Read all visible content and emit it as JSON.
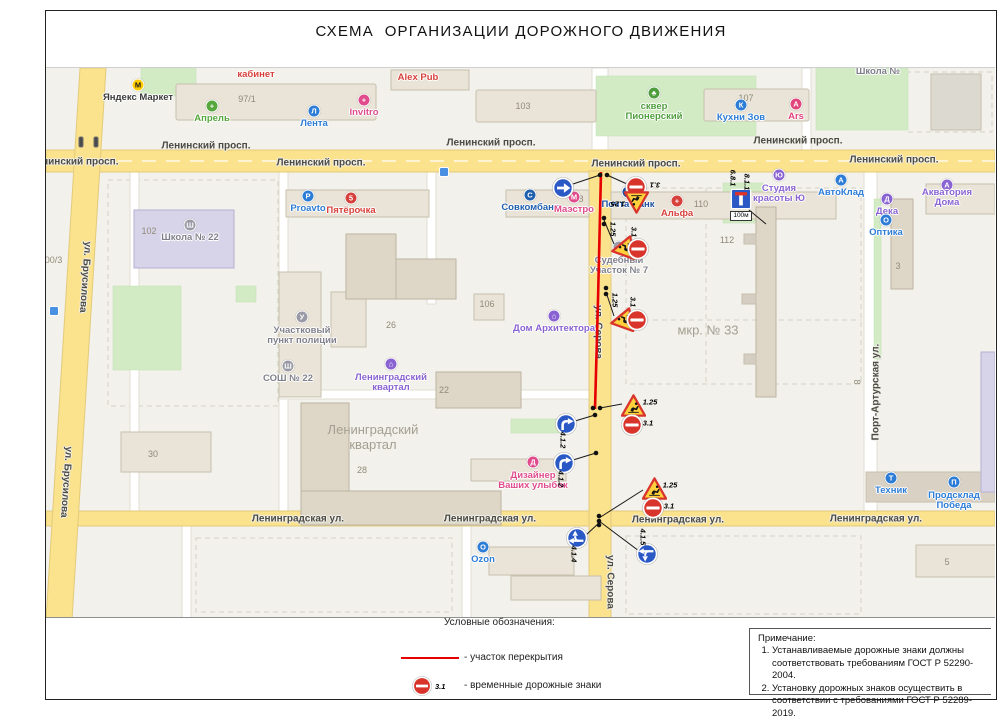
{
  "title": "СХЕМА  ОРГАНИЗАЦИИ ДОРОЖНОГО ДВИЖЕНИЯ",
  "legend": {
    "heading": "Условные обозначения:",
    "closure_label": "-  участок перекрытия",
    "signs_label": "- временные дорожные знаки",
    "sign_code": "3.1"
  },
  "notes": {
    "heading": "Примечание:",
    "items": [
      "Устанавливаемые дорожные знаки должны соответствовать требованиям ГОСТ Р 52290-2004.",
      "Установку дорожных знаков осуществить в соответствии с требованиями ГОСТ Р 52289-2019."
    ]
  },
  "colors": {
    "closure": "#e60000",
    "leader": "#1a1a1a",
    "sign_red": "#d8342c",
    "sign_blue": "#2a59c6",
    "temp_yellow": "#ffd03b",
    "road_yellow": "#fbe28c",
    "map_bg": "#f2f1eb"
  },
  "map": {
    "street_labels": [
      {
        "t": "Ленинский просп.",
        "x": 28,
        "y": 94
      },
      {
        "t": "Ленинский просп.",
        "x": 160,
        "y": 78
      },
      {
        "t": "Ленинский просп.",
        "x": 275,
        "y": 95
      },
      {
        "t": "Ленинский просп.",
        "x": 445,
        "y": 75
      },
      {
        "t": "Ленинский просп.",
        "x": 590,
        "y": 96
      },
      {
        "t": "Ленинский просп.",
        "x": 752,
        "y": 73
      },
      {
        "t": "Ленинский просп.",
        "x": 848,
        "y": 92
      },
      {
        "t": "Ленинградская ул.",
        "x": 252,
        "y": 451
      },
      {
        "t": "Ленинградская ул.",
        "x": 444,
        "y": 451
      },
      {
        "t": "Ленинградская ул.",
        "x": 632,
        "y": 452
      },
      {
        "t": "Ленинградская ул.",
        "x": 830,
        "y": 451
      },
      {
        "t": "ул. Брусилова",
        "x": 39,
        "y": 209,
        "rot": 94
      },
      {
        "t": "ул. Брусилова",
        "x": 20,
        "y": 414,
        "rot": 94
      },
      {
        "t": "ул. Серова",
        "x": 552,
        "y": 264,
        "rot": 90
      },
      {
        "t": "ул. Серова",
        "x": 564,
        "y": 514,
        "rot": 90
      },
      {
        "t": "Порт-Артурская ул.",
        "x": 830,
        "y": 324,
        "rot": -90
      }
    ],
    "area_labels": [
      {
        "t": "Ленинградский\nквартал",
        "x": 327,
        "y": 369
      },
      {
        "t": "мкр. № 33",
        "x": 662,
        "y": 262
      }
    ],
    "house_numbers": [
      {
        "t": "97/1",
        "x": 201,
        "y": 31
      },
      {
        "t": "102",
        "x": 103,
        "y": 163
      },
      {
        "t": "103",
        "x": 477,
        "y": 38
      },
      {
        "t": "106",
        "x": 441,
        "y": 236
      },
      {
        "t": "107",
        "x": 700,
        "y": 30
      },
      {
        "t": "110",
        "x": 655,
        "y": 136
      },
      {
        "t": "112",
        "x": 681,
        "y": 172
      },
      {
        "t": "128",
        "x": 530,
        "y": 131
      },
      {
        "t": "22",
        "x": 398,
        "y": 322
      },
      {
        "t": "26",
        "x": 345,
        "y": 257
      },
      {
        "t": "28",
        "x": 316,
        "y": 402
      },
      {
        "t": "30",
        "x": 107,
        "y": 386
      },
      {
        "t": "3",
        "x": 852,
        "y": 198
      },
      {
        "t": "5",
        "x": 901,
        "y": 494
      },
      {
        "t": "8",
        "x": 811,
        "y": 314,
        "rot": 90
      },
      {
        "t": "100/3",
        "x": 5,
        "y": 192
      }
    ],
    "pois": [
      {
        "id": "yandex-market",
        "t": "Яндекс Маркет",
        "x": 92,
        "y": 30,
        "c": "#3b3b3b",
        "g": "М",
        "bg": "#ffcc00",
        "gc": "#1a1a1a"
      },
      {
        "id": "aprel",
        "t": "Апрель",
        "x": 166,
        "y": 51,
        "c": "#56a73c",
        "g": "+",
        "bg": "#56a73c"
      },
      {
        "id": "lenta",
        "t": "Лента",
        "x": 268,
        "y": 56,
        "c": "#2d7cd6",
        "g": "Л",
        "bg": "#2d7cd6"
      },
      {
        "id": "invitro",
        "t": "Invitro",
        "x": 318,
        "y": 45,
        "c": "#df4b8b",
        "g": "+",
        "bg": "#df4b8b"
      },
      {
        "id": "alex-pub",
        "t": "Alex Pub",
        "x": 372,
        "y": 10,
        "c": "#d6413c"
      },
      {
        "id": "kabinet",
        "t": "кабинет",
        "x": 210,
        "y": 7,
        "c": "#d6413c"
      },
      {
        "id": "skver-pionersky",
        "t": "сквер\nПионерский",
        "x": 608,
        "y": 44,
        "c": "#4f9e3e",
        "g": "♣",
        "bg": "#4f9e3e"
      },
      {
        "id": "kuhni-zov",
        "t": "Кухни Зов",
        "x": 695,
        "y": 50,
        "c": "#2d7cd6",
        "g": "К",
        "bg": "#2d7cd6"
      },
      {
        "id": "ars",
        "t": "Ars",
        "x": 750,
        "y": 49,
        "c": "#e0457b",
        "g": "A",
        "bg": "#e0457b"
      },
      {
        "id": "shkola-n",
        "t": "Школа №",
        "x": 832,
        "y": 4,
        "c": "#80808c"
      },
      {
        "id": "proavto",
        "t": "Proavto",
        "x": 262,
        "y": 141,
        "c": "#2d7cd6",
        "g": "P",
        "bg": "#2d7cd6"
      },
      {
        "id": "pyaterochka",
        "t": "Пятёрочка",
        "x": 305,
        "y": 143,
        "c": "#d6413c",
        "g": "5",
        "bg": "#d6413c"
      },
      {
        "id": "sovcombank",
        "t": "Совкомбанк",
        "x": 484,
        "y": 140,
        "c": "#1f5fae",
        "g": "С",
        "bg": "#1f5fae"
      },
      {
        "id": "maestro",
        "t": "Маэстро",
        "x": 528,
        "y": 142,
        "c": "#df4b8b",
        "g": "М",
        "bg": "#df4b8b"
      },
      {
        "id": "pochta-bank",
        "t": "Почта Банк",
        "x": 582,
        "y": 137,
        "c": "#1d4f9e",
        "g": "П",
        "bg": "#1d4f9e"
      },
      {
        "id": "alfa",
        "t": "Альфа",
        "x": 631,
        "y": 146,
        "c": "#d6413c",
        "g": "+",
        "bg": "#d6413c"
      },
      {
        "id": "studia-krasoty",
        "t": "Студия\nкрасоты Ю",
        "x": 733,
        "y": 126,
        "c": "#8a63d2",
        "g": "Ю",
        "bg": "#8a63d2"
      },
      {
        "id": "avtoklad",
        "t": "АвтоКлад",
        "x": 795,
        "y": 125,
        "c": "#2d7cd6",
        "g": "А",
        "bg": "#2d7cd6"
      },
      {
        "id": "akvatoria-doma",
        "t": "Акватория Дома",
        "x": 901,
        "y": 130,
        "c": "#8a63d2",
        "g": "А",
        "bg": "#8a63d2"
      },
      {
        "id": "deka",
        "t": "Дека",
        "x": 841,
        "y": 144,
        "c": "#8a63d2",
        "g": "Д",
        "bg": "#8a63d2"
      },
      {
        "id": "optika",
        "t": "Оптика",
        "x": 840,
        "y": 165,
        "c": "#2d7cd6",
        "g": "О",
        "bg": "#2d7cd6"
      },
      {
        "id": "shkola-22",
        "t": "Школа № 22",
        "x": 144,
        "y": 170,
        "c": "#80808c",
        "g": "Ш",
        "bg": "#9a9aa6"
      },
      {
        "id": "uchastkovy-punkt",
        "t": "Участковый\nпункт полиции",
        "x": 256,
        "y": 268,
        "c": "#80808c",
        "g": "У",
        "bg": "#9a9aa6"
      },
      {
        "id": "sosh-22",
        "t": "СОШ № 22",
        "x": 242,
        "y": 311,
        "c": "#80808c",
        "g": "Ш",
        "bg": "#9a9aa6"
      },
      {
        "id": "leningradsky-kvartal",
        "t": "Ленинградский\nквартал",
        "x": 345,
        "y": 315,
        "c": "#8a63d2",
        "g": "⌂",
        "bg": "#8a63d2"
      },
      {
        "id": "dom-arkhitektora",
        "t": "Дом Архитектора",
        "x": 508,
        "y": 261,
        "c": "#8a63d2",
        "g": "⌂",
        "bg": "#8a63d2"
      },
      {
        "id": "sudebny-uchastok",
        "t": "Судебный\nУчасток № 7",
        "x": 573,
        "y": 198,
        "c": "#80808c",
        "g": "С",
        "bg": "#9a9aa6"
      },
      {
        "id": "dizayner-ulybok",
        "t": "Дизайнер\nВаших улыбок",
        "x": 487,
        "y": 413,
        "c": "#df4b8b",
        "g": "Д",
        "bg": "#df4b8b"
      },
      {
        "id": "ozon",
        "t": "Ozon",
        "x": 437,
        "y": 492,
        "c": "#2d7cd6",
        "g": "O",
        "bg": "#2d7cd6"
      },
      {
        "id": "tekhnik",
        "t": "Техник",
        "x": 845,
        "y": 423,
        "c": "#2d7cd6",
        "g": "Т",
        "bg": "#2d7cd6"
      },
      {
        "id": "prodsklad-pobeda",
        "t": "Продсклад\nПобеда",
        "x": 908,
        "y": 433,
        "c": "#2d7cd6",
        "g": "П",
        "bg": "#2d7cd6"
      }
    ],
    "furniture": [
      {
        "type": "traffic-light",
        "x": 35,
        "y": 74
      },
      {
        "type": "traffic-light",
        "x": 50,
        "y": 74
      },
      {
        "type": "transit",
        "x": 398,
        "y": 104
      },
      {
        "type": "transit",
        "x": 8,
        "y": 243
      }
    ],
    "closure_points": "555,104 552,232 549,341",
    "nodes": [
      [
        554,
        107
      ],
      [
        561,
        107
      ],
      [
        558,
        150
      ],
      [
        558,
        156
      ],
      [
        560,
        220
      ],
      [
        560,
        226
      ],
      [
        547,
        340
      ],
      [
        554,
        340
      ],
      [
        549,
        347
      ],
      [
        550,
        385
      ],
      [
        553,
        448
      ],
      [
        553,
        453
      ],
      [
        553,
        457
      ]
    ],
    "leaders": [
      [
        554,
        107,
        527,
        116
      ],
      [
        561,
        107,
        581,
        116
      ],
      [
        558,
        152,
        568,
        176
      ],
      [
        560,
        224,
        568,
        248
      ],
      [
        554,
        340,
        576,
        336
      ],
      [
        549,
        347,
        529,
        353
      ],
      [
        550,
        385,
        527,
        392
      ],
      [
        553,
        450,
        597,
        422
      ],
      [
        553,
        453,
        593,
        483
      ],
      [
        553,
        455,
        540,
        467
      ],
      [
        703,
        142,
        720,
        156
      ]
    ],
    "signs": [
      {
        "id": "s1",
        "code": "4.1.2",
        "type": "b412s",
        "x": 517,
        "y": 120
      },
      {
        "id": "s2",
        "code": "3.1",
        "type": "c31",
        "x": 590,
        "y": 119,
        "label": {
          "t": "3.1",
          "x": 609,
          "y": 117,
          "rot": 180
        }
      },
      {
        "id": "s3",
        "code": "1.25",
        "type": "t125",
        "x": 592,
        "y": 135,
        "rot": 180,
        "label": {
          "t": "1.25",
          "x": 572,
          "y": 136,
          "rot": 180
        }
      },
      {
        "id": "s4",
        "code": "1.25",
        "type": "t125",
        "x": 576,
        "y": 183,
        "rot": -100,
        "label": {
          "t": "1.25",
          "x": 567,
          "y": 161,
          "rot": 90
        }
      },
      {
        "id": "s5",
        "code": "3.1",
        "type": "c31",
        "x": 592,
        "y": 181,
        "label": {
          "t": "3.1",
          "x": 588,
          "y": 164,
          "rot": 90
        }
      },
      {
        "id": "s6",
        "code": "1.25",
        "type": "t125",
        "x": 575,
        "y": 255,
        "rot": -100,
        "label": {
          "t": "1.25",
          "x": 569,
          "y": 232,
          "rot": 90
        }
      },
      {
        "id": "s7",
        "code": "3.1",
        "type": "c31",
        "x": 591,
        "y": 252,
        "label": {
          "t": "3.1",
          "x": 587,
          "y": 234,
          "rot": 90
        }
      },
      {
        "id": "s8",
        "code": "1.25",
        "type": "t125",
        "x": 586,
        "y": 337,
        "label": {
          "t": "1.25",
          "x": 604,
          "y": 334
        }
      },
      {
        "id": "s9",
        "code": "3.1",
        "type": "c31",
        "x": 586,
        "y": 357,
        "label": {
          "t": "3.1",
          "x": 602,
          "y": 355
        }
      },
      {
        "id": "s10",
        "code": "4.1.2",
        "type": "b412c",
        "x": 520,
        "y": 356,
        "label": {
          "t": "4.1.2",
          "x": 517,
          "y": 372,
          "rot": 90
        }
      },
      {
        "id": "s11",
        "code": "4.1.2",
        "type": "b412c",
        "x": 518,
        "y": 395,
        "label": {
          "t": "4.1.2",
          "x": 515,
          "y": 411,
          "rot": 90
        }
      },
      {
        "id": "s12",
        "code": "1.25",
        "type": "t125",
        "x": 607,
        "y": 420,
        "label": {
          "t": "1.25",
          "x": 624,
          "y": 417
        }
      },
      {
        "id": "s13",
        "code": "3.1",
        "type": "c31",
        "x": 607,
        "y": 440,
        "label": {
          "t": "3.1",
          "x": 623,
          "y": 438
        }
      },
      {
        "id": "s14",
        "code": "4.1.4",
        "type": "b414",
        "x": 531,
        "y": 470,
        "rot": -90,
        "label": {
          "t": "4.1.4",
          "x": 528,
          "y": 486,
          "rot": 90
        }
      },
      {
        "id": "s15",
        "code": "4.1.5",
        "type": "b415",
        "x": 601,
        "y": 486,
        "rot": -90,
        "label": {
          "t": "4.1.5",
          "x": 597,
          "y": 469,
          "rot": 90
        }
      },
      {
        "id": "s16",
        "code": "6.8.1",
        "type": "b681",
        "x": 695,
        "y": 131,
        "plate": "100м",
        "label": {
          "t": "6.8.1",
          "x": 687,
          "y": 110,
          "rot": 90
        },
        "label2": {
          "t": "8.1.1",
          "x": 701,
          "y": 114,
          "rot": 90
        }
      }
    ]
  }
}
